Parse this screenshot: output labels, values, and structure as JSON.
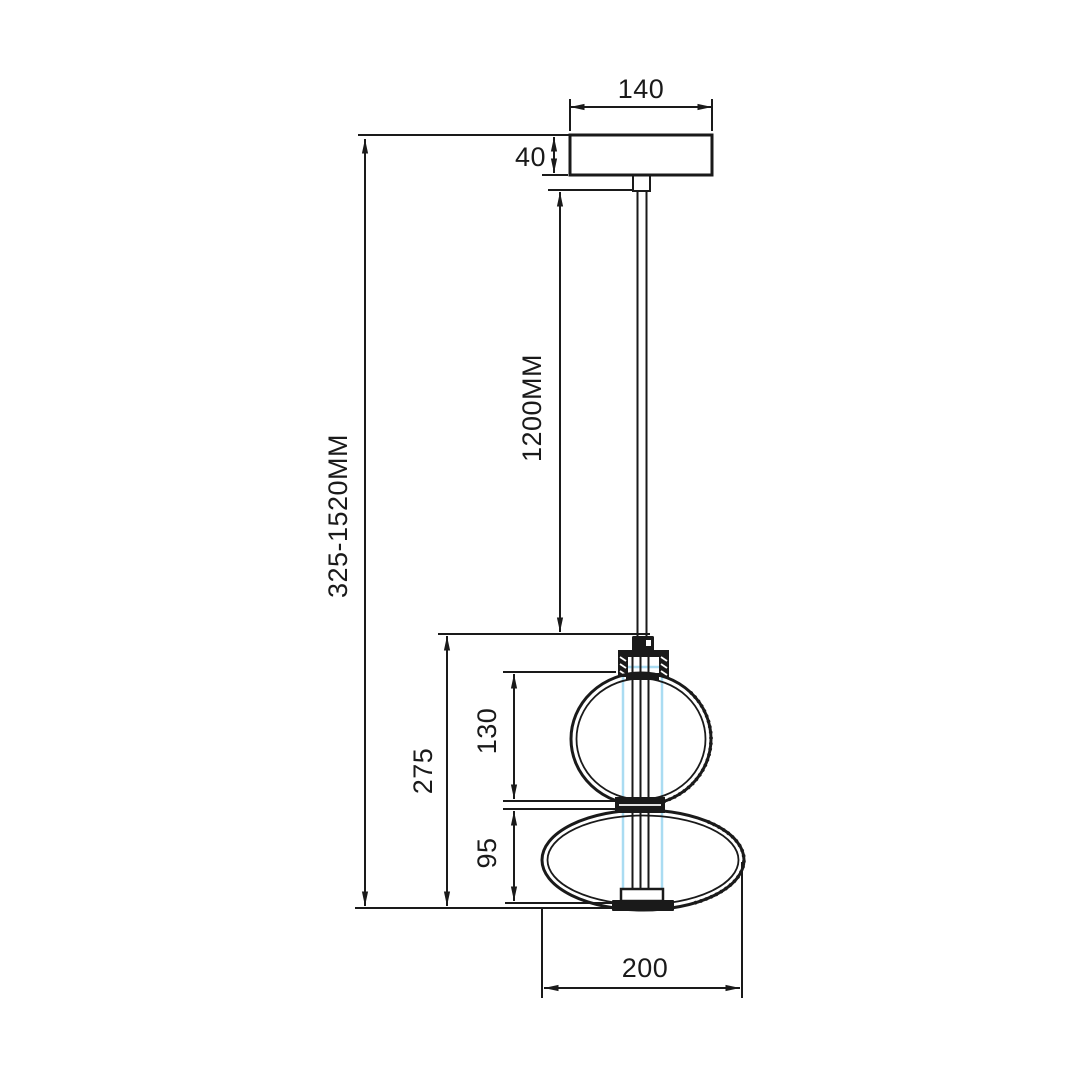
{
  "drawing": {
    "type": "technical-dimension-diagram",
    "subject": "double-globe glass pendant lamp, front elevation with dimensions",
    "units": "mm",
    "dimensions": {
      "canopy_width": "140",
      "canopy_height": "40",
      "cable_length": "1200MM",
      "overall_height": "325-1520MM",
      "shade_total_height": "275",
      "upper_globe_height": "130",
      "lower_globe_height": "95",
      "shade_diameter": "200"
    },
    "colors": {
      "line": "#1a1a1a",
      "glass_inner_tube": "#aadcf2",
      "background": "#ffffff"
    }
  }
}
